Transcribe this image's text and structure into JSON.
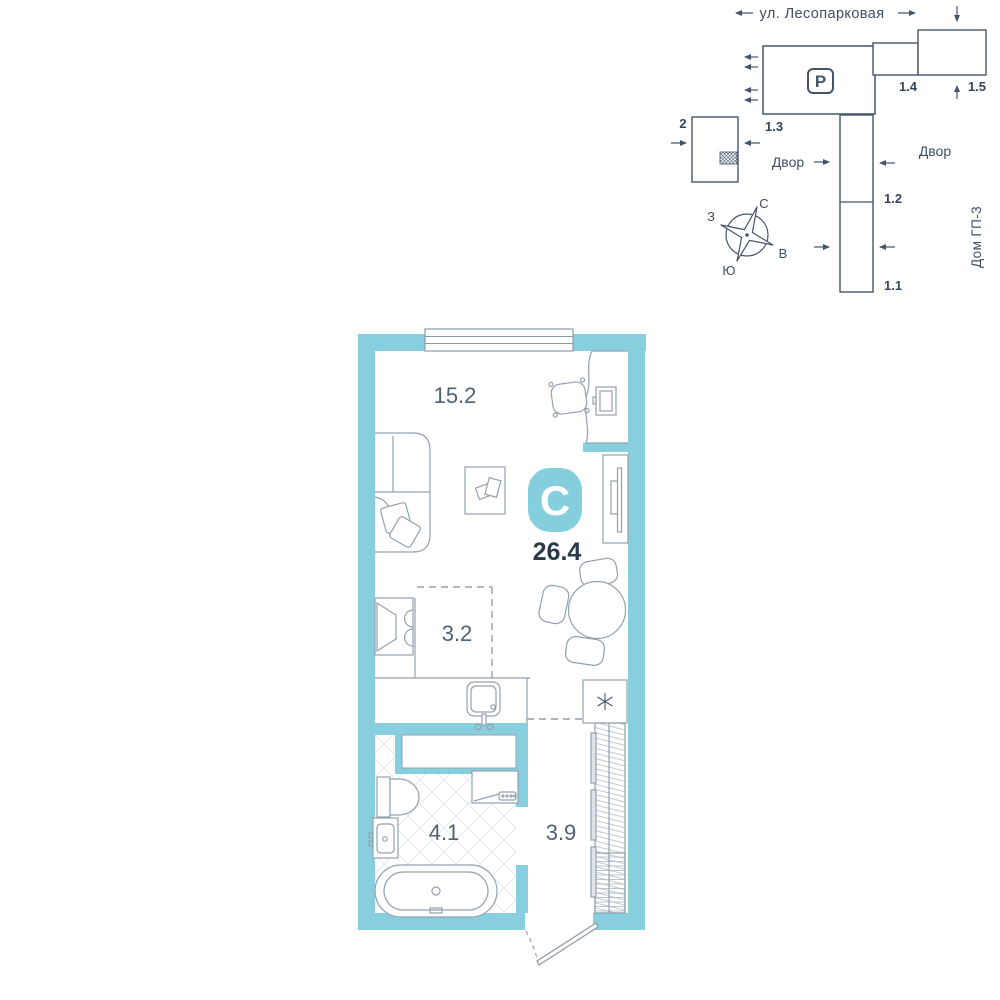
{
  "site_plan": {
    "street": "ул. Лесопарковая",
    "parking": "P",
    "yard_left": "Двор",
    "yard_right": "Двор",
    "house": "Дом ГП-3",
    "buildings": {
      "b2": "2",
      "b11": "1.1",
      "b12": "1.2",
      "b13": "1.3",
      "b14": "1.4",
      "b15": "1.5"
    },
    "compass": {
      "n": "С",
      "e": "В",
      "s": "Ю",
      "w": "З"
    }
  },
  "apartment": {
    "badge": "С",
    "total_area": "26.4",
    "living_area": "15.2",
    "kitchen_area": "3.2",
    "bathroom_area": "4.1",
    "hallway_area": "3.9"
  },
  "colors": {
    "wall_teal": "#87CFDF",
    "badge_teal": "#85CEDE",
    "line_dark": "#44556B",
    "line_light": "#93A1AF",
    "tile_line": "#E3E9EE",
    "text_dark": "#2A3A4C",
    "text_medium": "#4F6173"
  }
}
